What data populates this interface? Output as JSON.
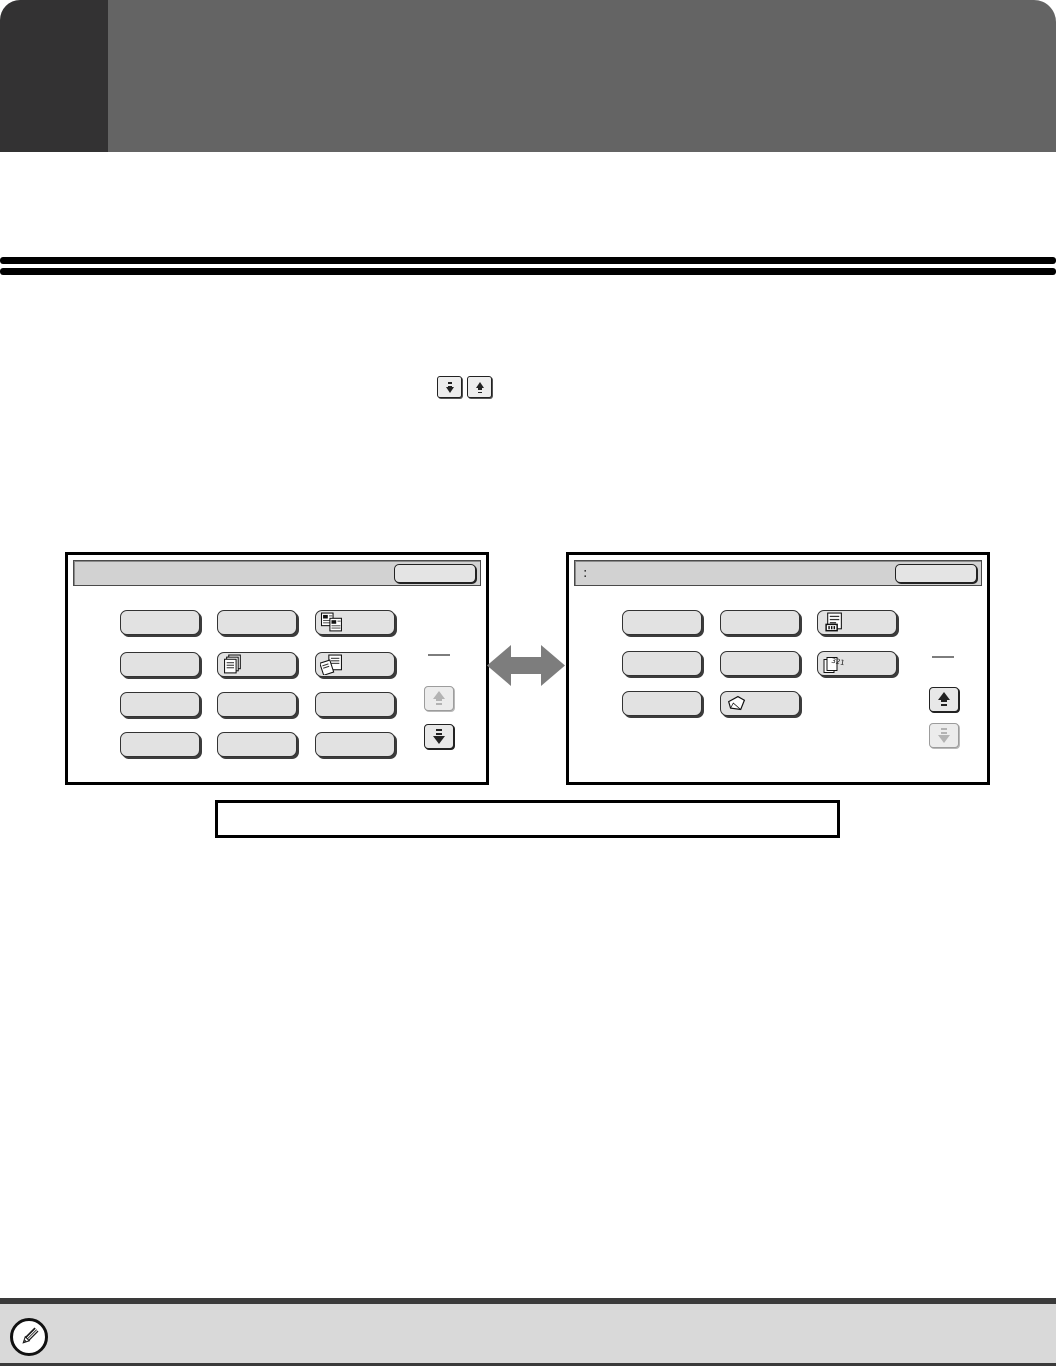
{
  "page": {
    "kind": "operation-manual-page",
    "colors": {
      "chapter_tab": "#333233",
      "chapter_band": "#646464",
      "rule": "#000000",
      "key_fill": "#e2e2e2",
      "titlebar_fill": "#d2d2d2",
      "note_bar_bg": "#d9d9d9",
      "swap_arrow_gray": "#7d7d7d"
    }
  },
  "inline_keys": [
    {
      "icon": "down-arrow-icon"
    },
    {
      "icon": "up-arrow-icon"
    }
  ],
  "left_panel": {
    "titlebar_text": "",
    "ok_label": "",
    "page_indicator": "",
    "scroll_up_state": "disabled",
    "scroll_down_state": "enabled",
    "keys": [
      {
        "label": "",
        "icon": ""
      },
      {
        "label": "",
        "icon": ""
      },
      {
        "label": "",
        "icon": "two-pages-icon"
      },
      {
        "label": "",
        "icon": ""
      },
      {
        "label": "",
        "icon": "document-stack-icon"
      },
      {
        "label": "",
        "icon": "document-stack-fan-icon"
      },
      {
        "label": "",
        "icon": ""
      },
      {
        "label": "",
        "icon": ""
      },
      {
        "label": "",
        "icon": ""
      },
      {
        "label": "",
        "icon": ""
      },
      {
        "label": "",
        "icon": ""
      },
      {
        "label": "",
        "icon": ""
      }
    ]
  },
  "right_panel": {
    "titlebar_text": ":",
    "ok_label": "",
    "page_indicator": "",
    "scroll_up_state": "enabled",
    "scroll_down_state": "disabled",
    "keys": [
      {
        "label": "",
        "icon": ""
      },
      {
        "label": "",
        "icon": ""
      },
      {
        "label": "",
        "icon": "numbered-page-icon"
      },
      {
        "label": "",
        "icon": ""
      },
      {
        "label": "",
        "icon": ""
      },
      {
        "label": "",
        "icon": "reverse-order-321-icon",
        "overlay_text": "321"
      },
      {
        "label": "",
        "icon": ""
      },
      {
        "label": "",
        "icon": "tilted-sheet-icon"
      }
    ]
  },
  "caption_box": {
    "text": ""
  },
  "note_bar": {
    "icon": "pencil-icon",
    "text": ""
  }
}
